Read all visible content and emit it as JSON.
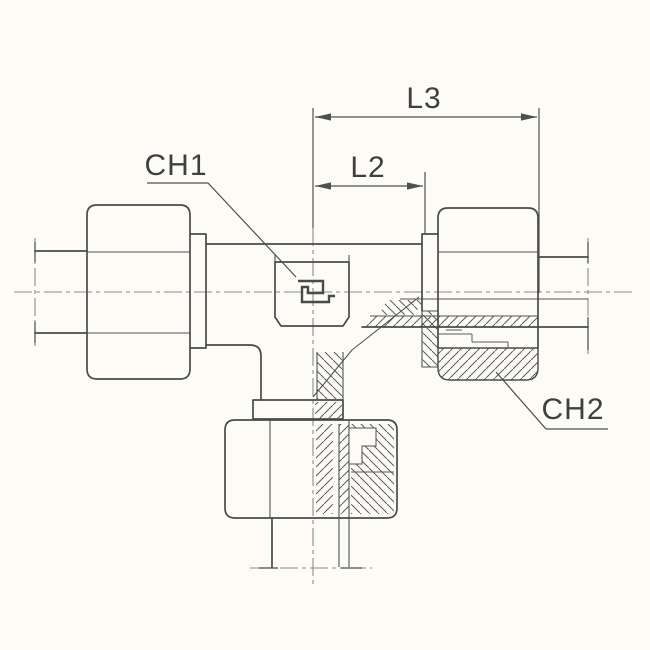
{
  "colors": {
    "background": "#fcfbf6",
    "line": "#4a4a4a",
    "centerline": "#8b8b8b",
    "dimension": "#4f4f4f",
    "text": "#3f3f3f",
    "hatch": "#5c5c5c"
  },
  "diagram": {
    "labels": {
      "l3": "L3",
      "l2": "L2",
      "ch1": "CH1",
      "ch2": "CH2"
    }
  }
}
